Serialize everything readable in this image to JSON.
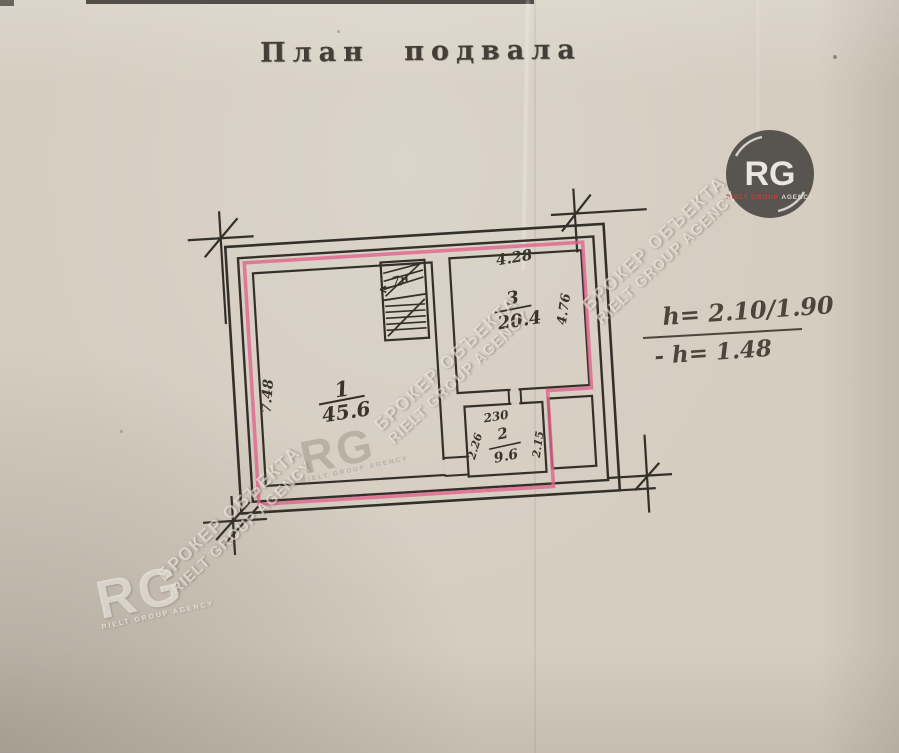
{
  "title": "План подвала",
  "plan": {
    "room1": {
      "number": "1",
      "area": "45.6"
    },
    "room2": {
      "number": "2",
      "area": "9.6",
      "width_top": "230",
      "dim_left": "2.26",
      "dim_right": "2.15"
    },
    "room3": {
      "number": "3",
      "area": "20.4",
      "dim_top": "4.28",
      "dim_right": "4.76"
    },
    "dim_left_wall": "7.48",
    "stairs_label": "7н"
  },
  "annotations": {
    "height_line1": "h= 2.10/1.90",
    "height_line2": "- h= 1.48"
  },
  "logo": {
    "initials": "RG",
    "brand": "RIELT GROUP",
    "suffix": "AGENCY"
  },
  "watermark": {
    "line1": "БРОКЕР ОБЪЕКТА",
    "line2": "RIELT GROUP AGENCY",
    "initials": "RG",
    "caption": "RIELT GROUP AGENCY"
  },
  "colors": {
    "plan_outline": "#e0648c",
    "ink": "#33302a",
    "logo_bg": "#514d4a",
    "logo_brand": "#b23a33"
  }
}
